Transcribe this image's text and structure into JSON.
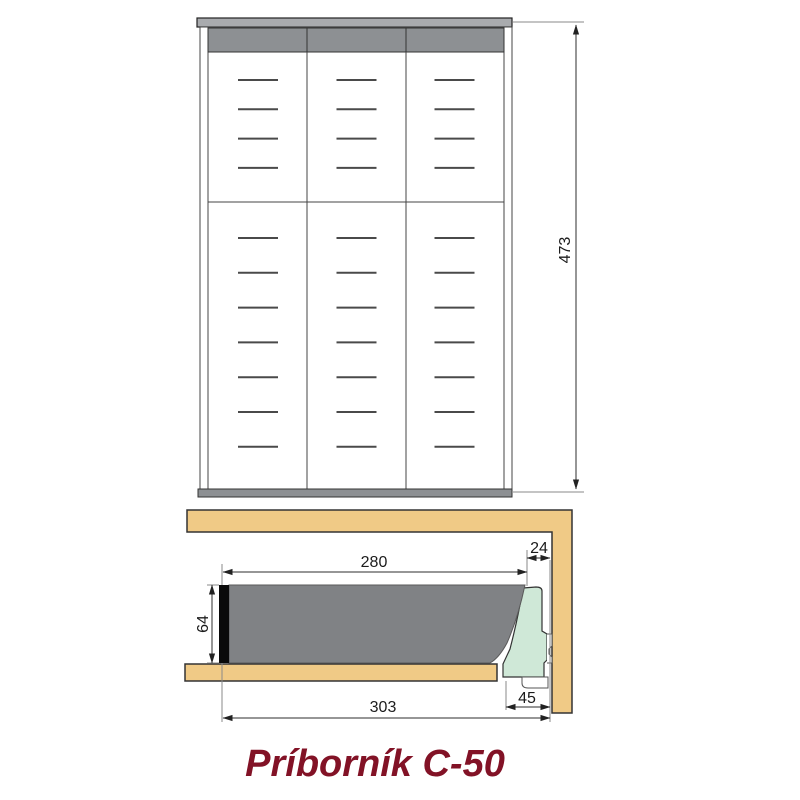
{
  "title": "Príborník C-50",
  "drawing": {
    "kind": "cutlery-tray-technical-drawing",
    "views": {
      "top": {
        "name": "top-view-plan",
        "columns": 3,
        "upper_slot_rows": 4,
        "lower_slot_rows": 7,
        "dim_height": "473"
      },
      "side": {
        "name": "side-section-view",
        "dim_inner_depth": "280",
        "dim_back_gap": "24",
        "dim_tray_height": "64",
        "dim_total_depth": "303",
        "dim_runner": "45"
      }
    },
    "colors": {
      "wood": "#f0ca86",
      "tray": "#808285",
      "top_rail": "#a9abae",
      "dark_band": "#8d9093",
      "bottom_bar": "#8d9093",
      "soft_close": "#cfe8d7",
      "front_edge": "#0a0a0a",
      "title": "#821226"
    }
  }
}
